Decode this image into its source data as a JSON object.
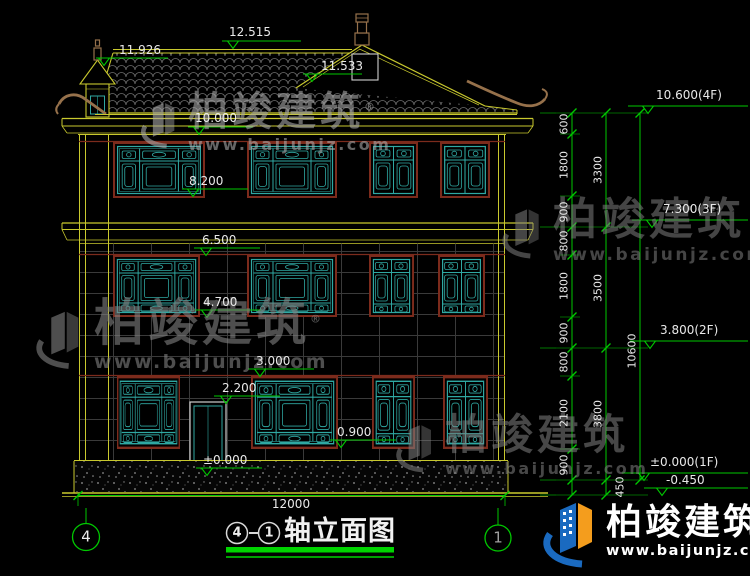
{
  "drawing": {
    "kind": "house front elevation CAD drawing",
    "title": {
      "circle_left": "4",
      "dash": "-",
      "circle_right": "1",
      "text": "轴立面图"
    },
    "axis_bubbles": {
      "left": "4",
      "right": "1"
    }
  },
  "levels_left": [
    "12.515",
    "11.926",
    "11.533",
    "10.000",
    "8.200",
    "6.500",
    "4.700",
    "3.000",
    "2.200",
    "0.900",
    "±0.000"
  ],
  "levels_right": [
    "10.600(4F)",
    "7.300(3F)",
    "3.800(2F)",
    "±0.000(1F)",
    "-0.450"
  ],
  "dims": {
    "chain_small": [
      "600",
      "1800",
      "900",
      "800",
      "1800",
      "900",
      "800",
      "2100",
      "900"
    ],
    "below_ground": "450",
    "chain_mid": [
      "3300",
      "3500",
      "3800"
    ],
    "total_height": "10600",
    "total_width": "12000"
  },
  "watermark": {
    "brand": "柏竣建筑",
    "reg": "®",
    "url": "www.baijunjz.com"
  },
  "colors": {
    "line_yellow": "#c9c92e",
    "window_teal": "#2fa8a2",
    "frame_maroon": "#7c2b1c",
    "dim_green": "#00c800",
    "brand_blue": "#1a6ac0",
    "brand_orange": "#f49d1d"
  }
}
